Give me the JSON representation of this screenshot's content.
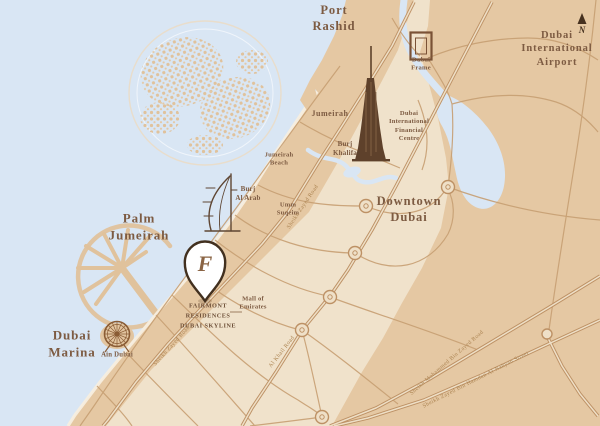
{
  "page": {
    "type": "map-illustration",
    "title": "Fairmont Residences Dubai Skyline location map"
  },
  "colors": {
    "water": "#d9e6f4",
    "land": "#e5c8a3",
    "land_light": "#f0e2cb",
    "beach": "#f7eedf",
    "road": "#c79f73",
    "highway": "#bd9165",
    "label_text": "#7d5b42",
    "road_label_text": "#ad8553",
    "icon_brown": "#5e412b",
    "pin_fill": "#ffffff",
    "pin_outline": "#42301f"
  },
  "labels": {
    "port_rashid": "Port\nRashid",
    "airport": "Dubai\nInternational\nAirport",
    "compass_n": "N",
    "dubai_frame": "Dubai\nFrame",
    "jumeirah": "Jumeirah",
    "difc": "Dubai\nInternational\nFinancial\nCentre",
    "burj_khalifa": "Burj\nKhalifa",
    "jumeirah_beach": "Jumeirah\nBeach",
    "burj_al_arab": "Burj\nAl Arab",
    "umm_suqeim": "Umm\nSuqeim",
    "downtown_dubai": "Downtown\nDubai",
    "palm_jumeirah": "Palm\nJumeirah",
    "mall_of_emirates": "Mall of\nEmirates",
    "property": "FAIRMONT\nRESIDENCES\nDUBAI SKYLINE",
    "dubai_marina": "Dubai\nMarina",
    "ain_dubai": "Ain Dubai"
  },
  "roads": {
    "sheikh_zayed_road": "Sheikh Zayed Road",
    "al_khail_road": "Al Khail Road",
    "sheikh_mohammed_bin_zayed_road": "Sheikh Mohammed Bin Zayed Road",
    "sheikh_zayed_bin_hamdan_street": "Sheikh Zayed Bin Hamdan Al Nahyan Street"
  },
  "icons": {
    "pin_monogram": "F",
    "north_arrow": "▲",
    "names": [
      "location-pin",
      "fairmont-monogram",
      "burj-khalifa-icon",
      "burj-al-arab-icon",
      "dubai-frame-icon",
      "ain-dubai-ferris-wheel-icon",
      "north-arrow-icon",
      "world-islands",
      "palm-jumeirah-island"
    ]
  }
}
